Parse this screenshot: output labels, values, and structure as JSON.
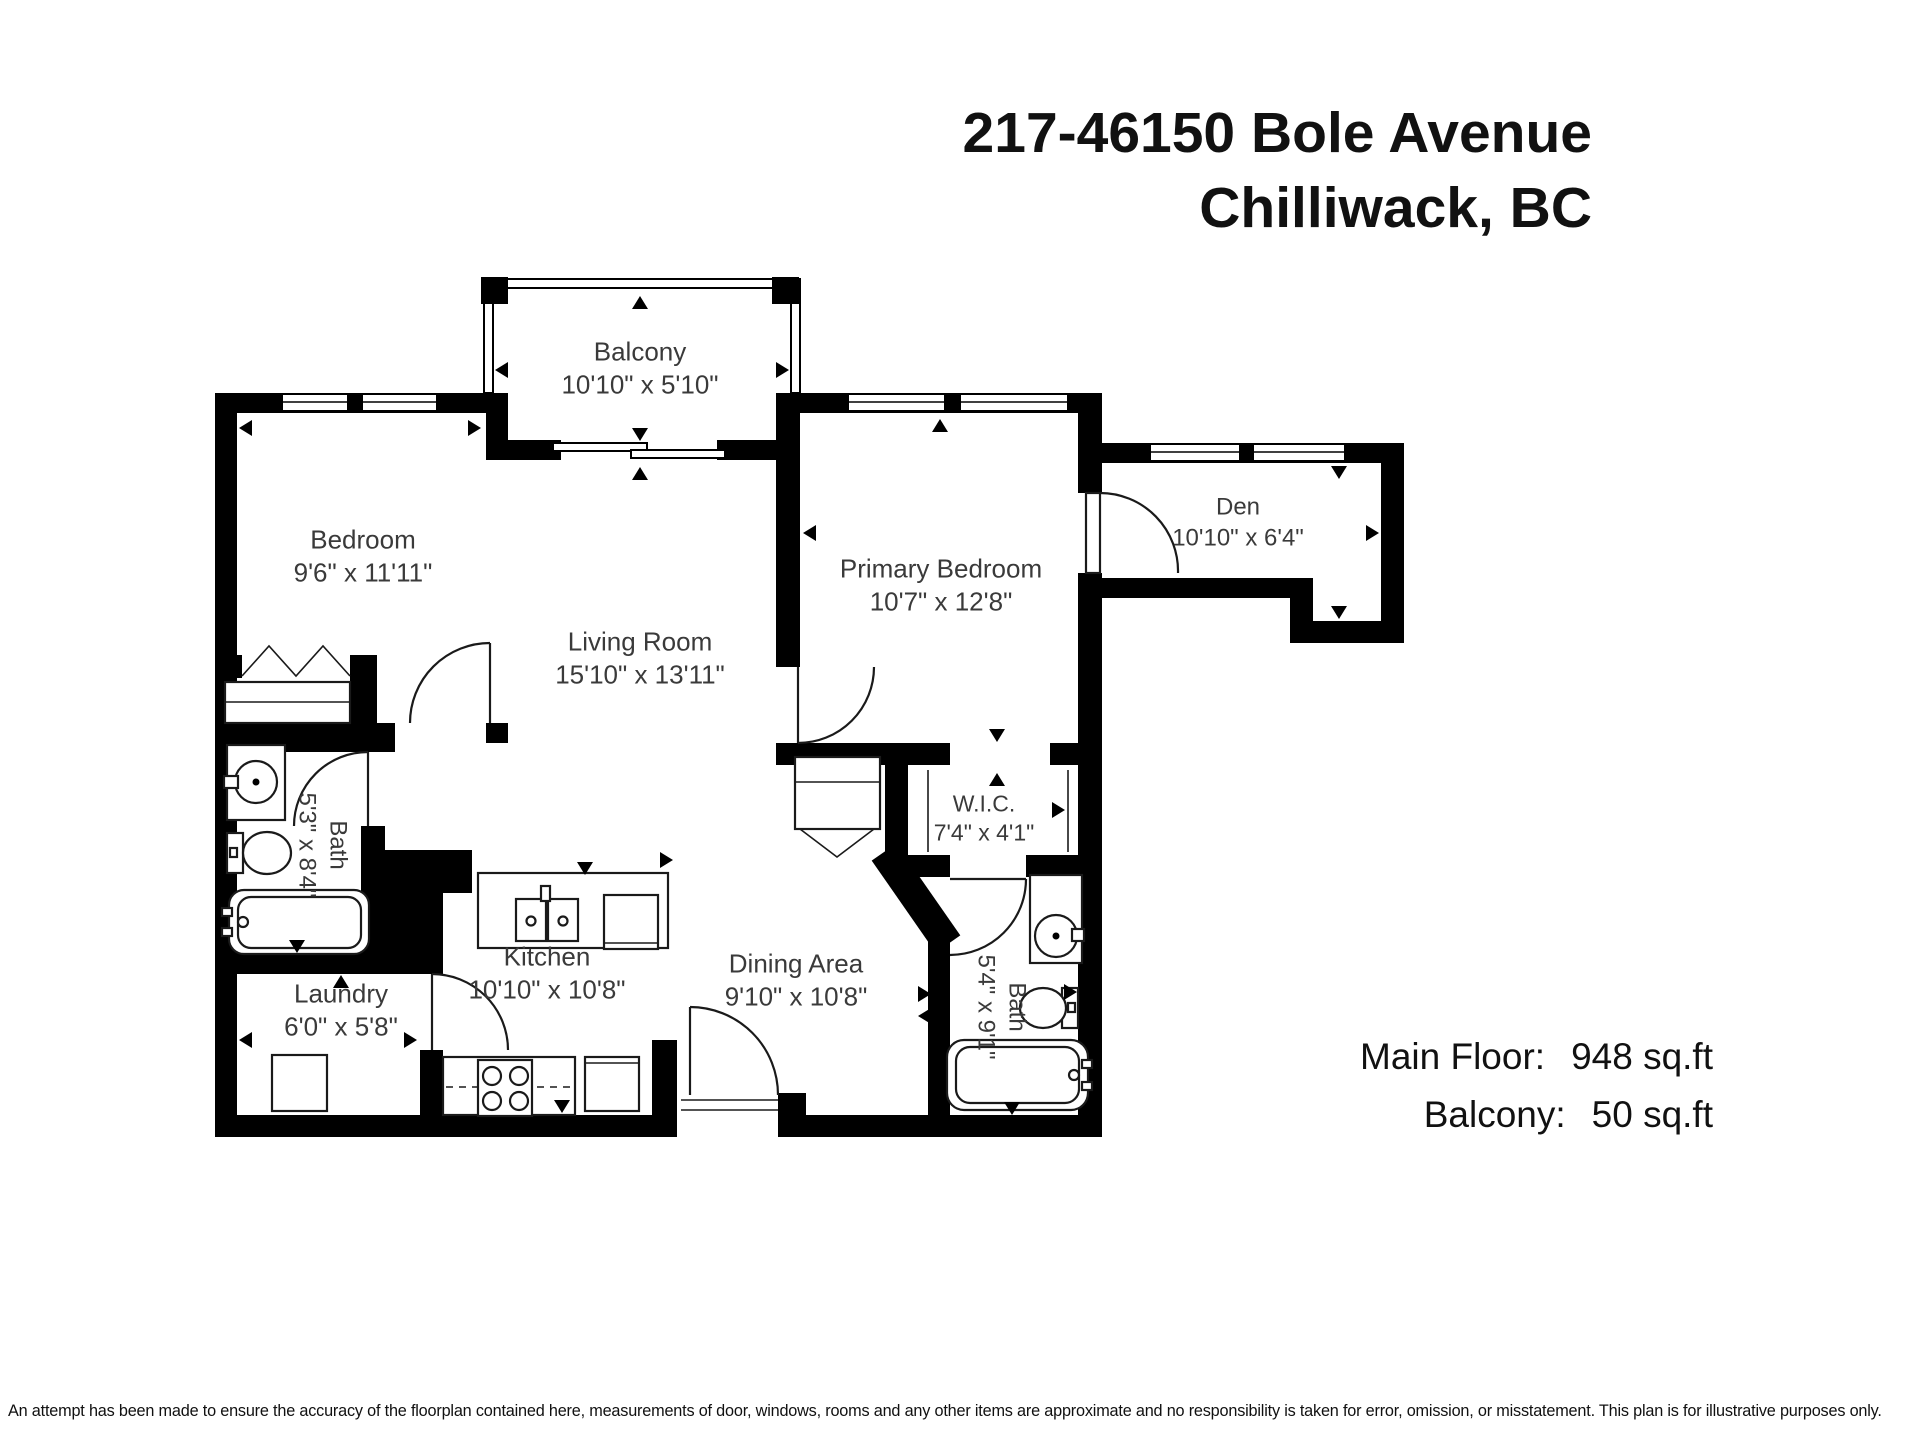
{
  "title": {
    "line1": "217-46150 Bole Avenue",
    "line2": "Chilliwack, BC"
  },
  "rooms": [
    {
      "name": "Balcony",
      "dims": "10'10\" x 5'10\""
    },
    {
      "name": "Bedroom",
      "dims": "9'6\" x 11'11\""
    },
    {
      "name": "Living Room",
      "dims": "15'10\" x 13'11\""
    },
    {
      "name": "Primary Bedroom",
      "dims": "10'7\" x 12'8\""
    },
    {
      "name": "Den",
      "dims": "10'10\" x 6'4\""
    },
    {
      "name": "W.I.C.",
      "dims": "7'4\" x 4'1\""
    },
    {
      "name": "Bath",
      "dims": "5'3\" x 8'4\""
    },
    {
      "name": "Bath",
      "dims": "5'4\" x 9'1\""
    },
    {
      "name": "Kitchen",
      "dims": "10'10\" x 10'8\""
    },
    {
      "name": "Dining Area",
      "dims": "9'10\" x 10'8\""
    },
    {
      "name": "Laundry",
      "dims": "6'0\" x 5'8\""
    }
  ],
  "areas": {
    "main_floor_label": "Main Floor:",
    "main_floor_value": "948 sq.ft",
    "balcony_label": "Balcony:",
    "balcony_value": "50 sq.ft"
  },
  "disclaimer": "An attempt has been made to ensure the accuracy of the floorplan contained here, measurements of door, windows, rooms and any other items are approximate and no responsibility is taken for error, omission, or misstatement. This plan is for illustrative purposes only.",
  "colors": {
    "wall": "#000000",
    "label": "#3a3a3a",
    "background": "#ffffff",
    "ink": "#111111",
    "line": "#1a1a1a"
  }
}
